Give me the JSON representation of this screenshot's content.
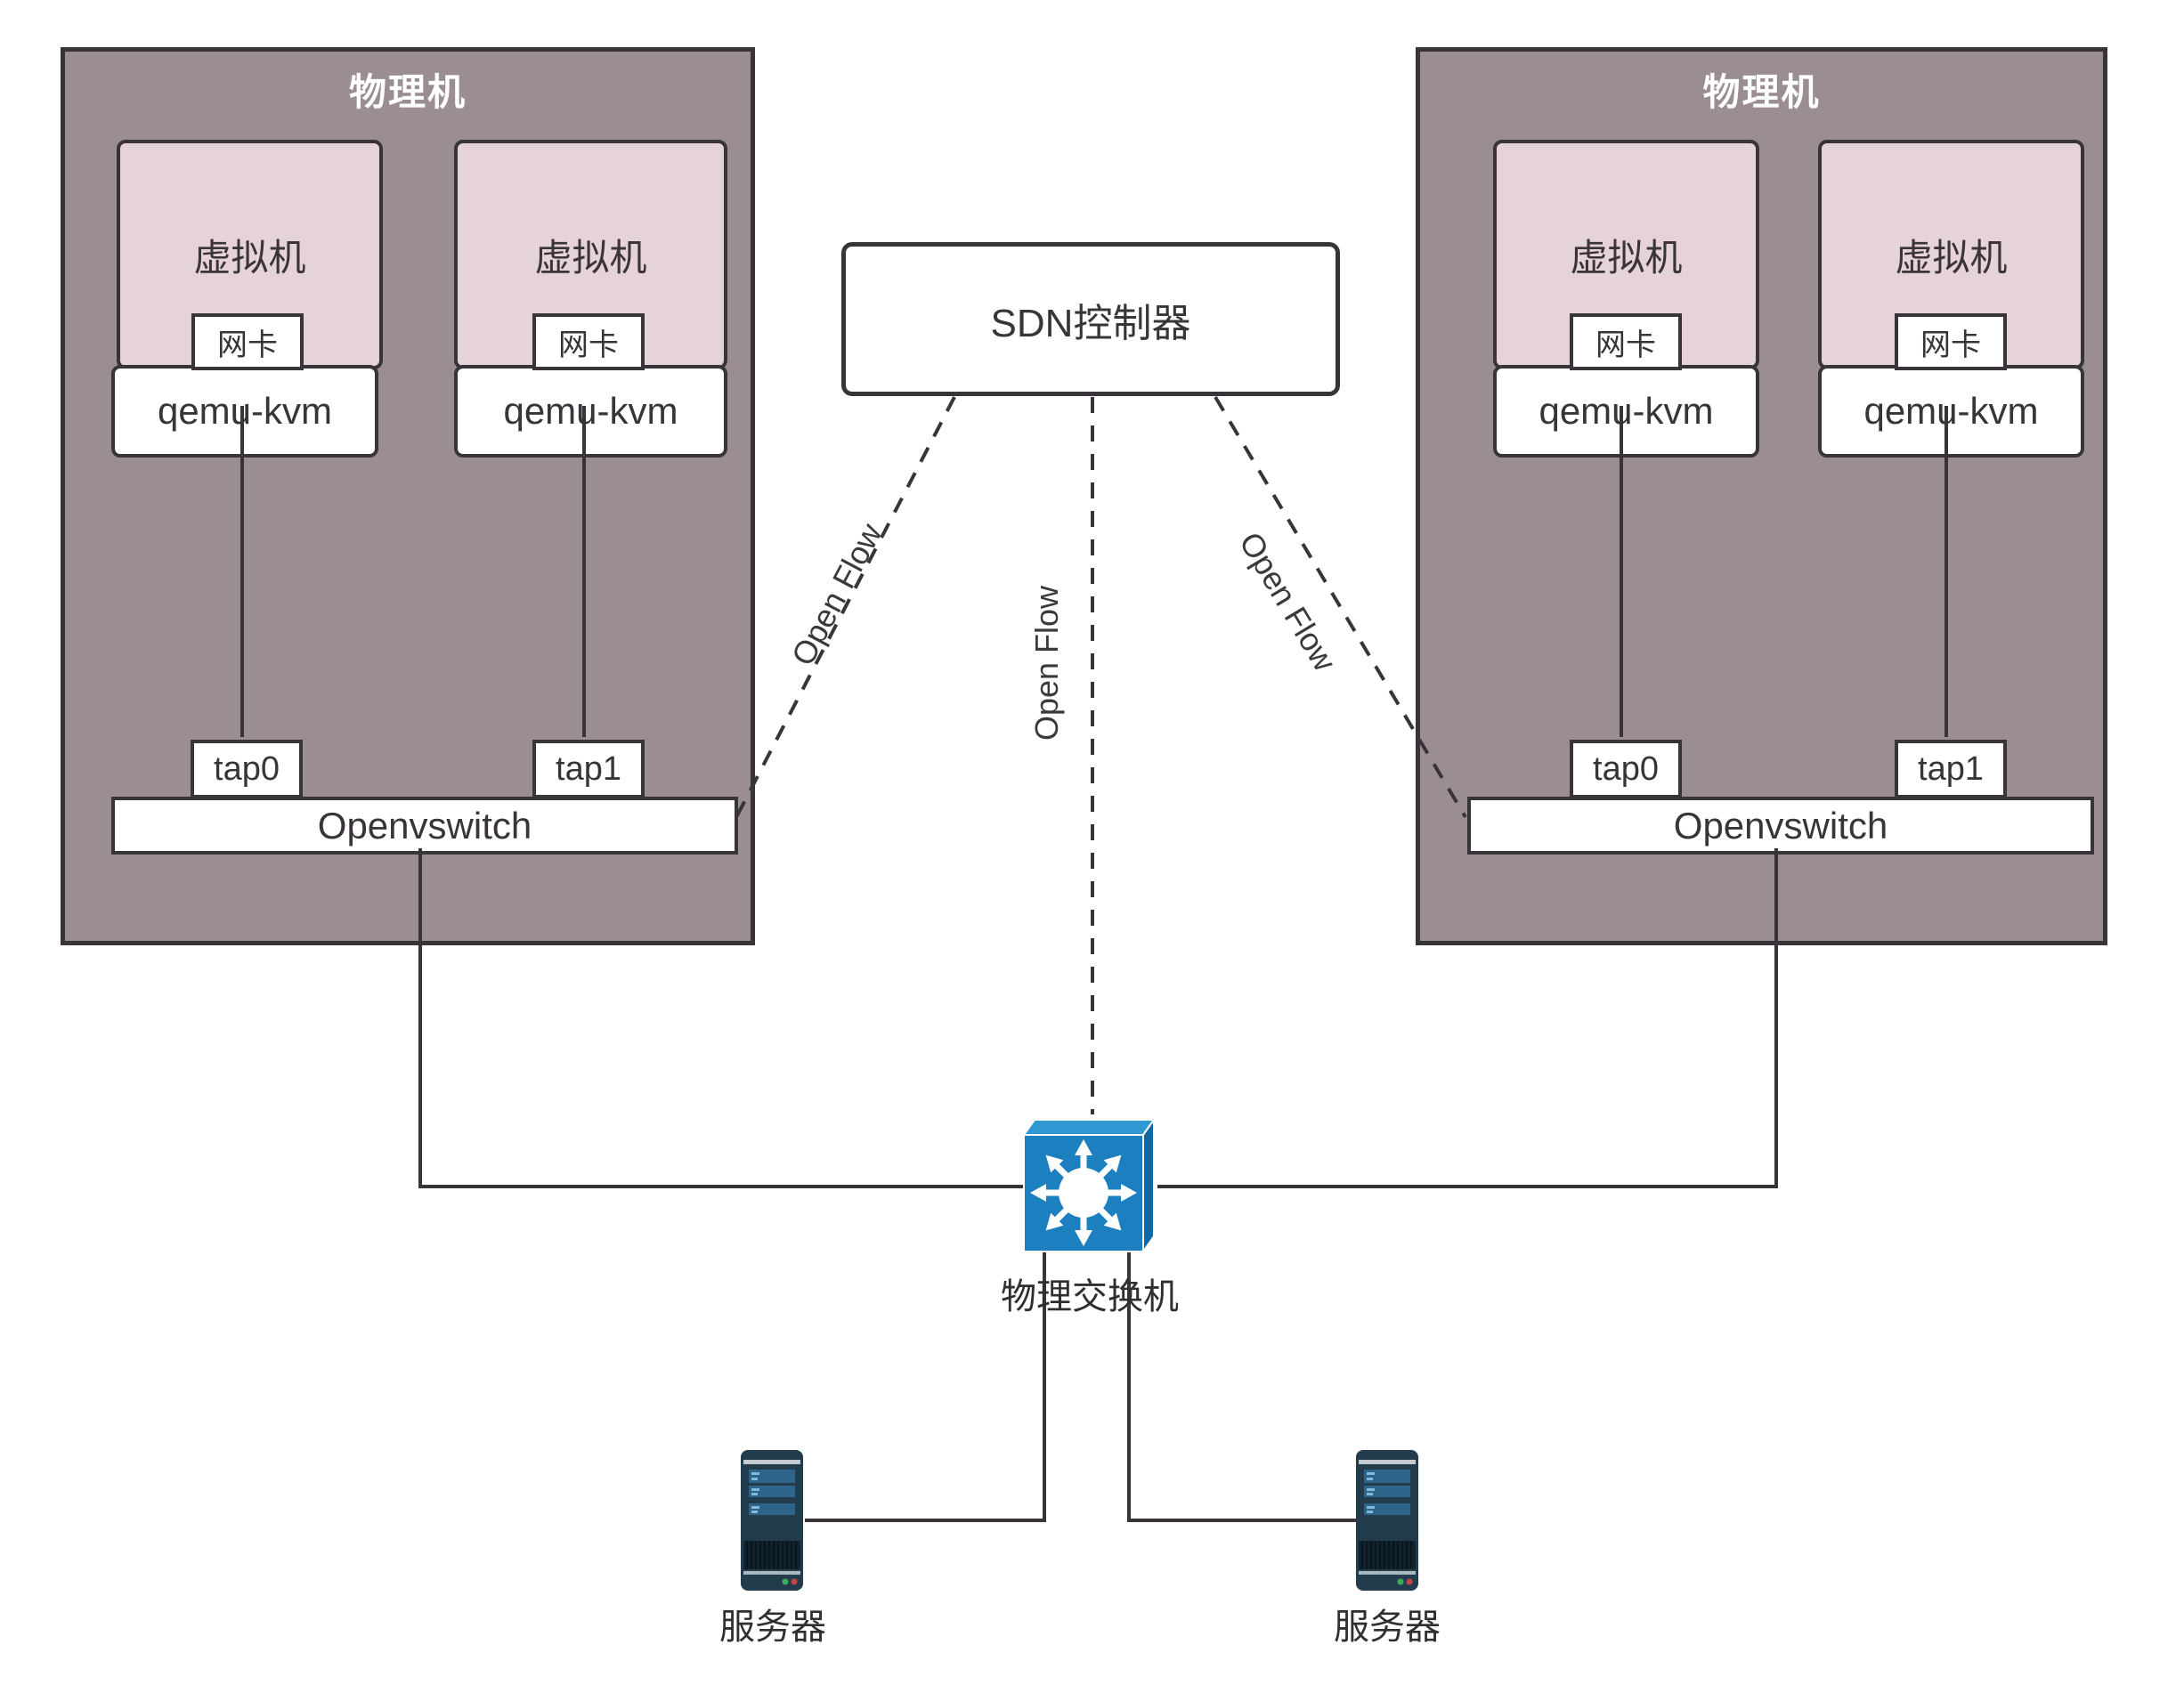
{
  "machines": {
    "left": {
      "title": "物理机",
      "vms": [
        {
          "label": "虚拟机",
          "nic_label": "网卡",
          "hypervisor_label": "qemu-kvm"
        },
        {
          "label": "虚拟机",
          "nic_label": "网卡",
          "hypervisor_label": "qemu-kvm"
        }
      ],
      "taps": [
        "tap0",
        "tap1"
      ],
      "vswitch_label": "Openvswitch"
    },
    "right": {
      "title": "物理机",
      "vms": [
        {
          "label": "虚拟机",
          "nic_label": "网卡",
          "hypervisor_label": "qemu-kvm"
        },
        {
          "label": "虚拟机",
          "nic_label": "网卡",
          "hypervisor_label": "qemu-kvm"
        }
      ],
      "taps": [
        "tap0",
        "tap1"
      ],
      "vswitch_label": "Openvswitch"
    }
  },
  "controller": {
    "label": "SDN控制器"
  },
  "links": {
    "openflow_label": "Open Flow"
  },
  "physical_switch": {
    "label": "物理交换机"
  },
  "servers": [
    {
      "label": "服务器"
    },
    {
      "label": "服务器"
    }
  ],
  "colors": {
    "machine_fill": "#9b8e93",
    "machine_border": "#38343a",
    "vm_fill": "#e6d3d9",
    "box_fill": "#ffffff",
    "line": "#38343a",
    "switch_front": "#1b7fc0",
    "switch_top": "#2f97d1",
    "switch_side": "#0f69a4",
    "server_body": "#223c4c",
    "server_bar": "#2e638a",
    "led_green": "#3cae5b",
    "led_red": "#c24444",
    "title_text": "#ffffff",
    "text": "#38343a"
  }
}
